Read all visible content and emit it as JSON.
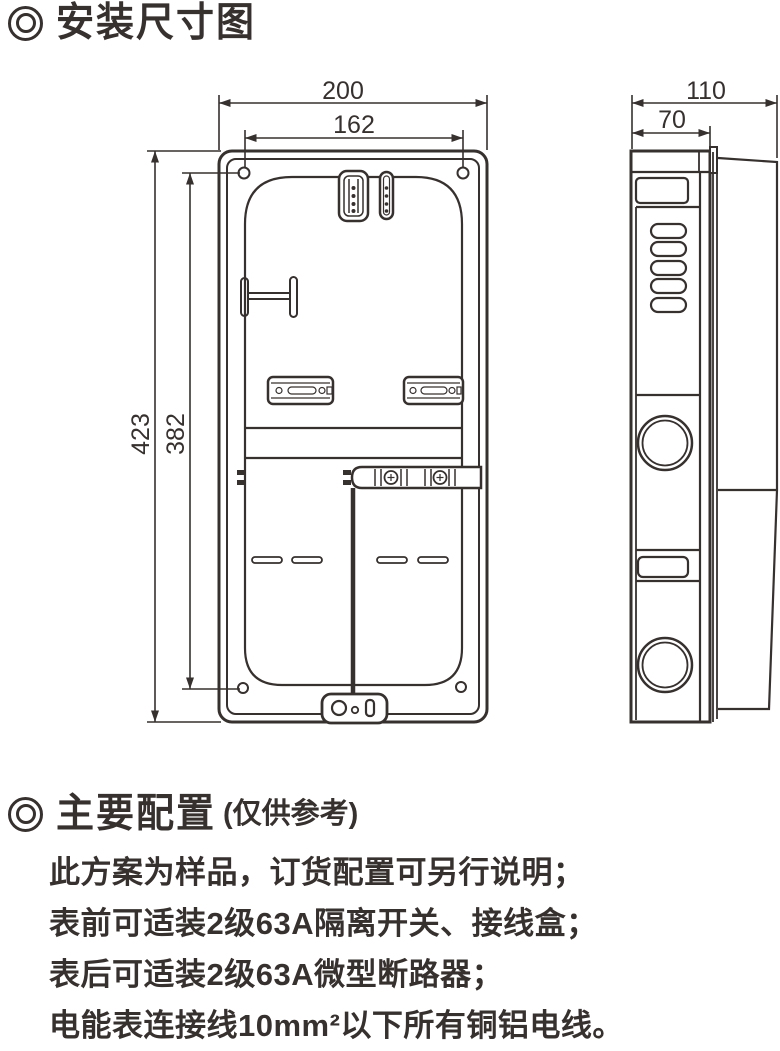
{
  "colors": {
    "ink": "#36302e"
  },
  "section1": {
    "title": "安装尺寸图"
  },
  "dimensions": {
    "front": {
      "width_outer": "200",
      "width_inner": "162",
      "height_outer": "423",
      "height_inner": "382"
    },
    "side": {
      "depth_outer": "110",
      "depth_front": "70"
    }
  },
  "section2": {
    "title": "主要配置",
    "title_note": "(仅供参考)",
    "lines": [
      "此方案为样品，订货配置可另行说明；",
      "表前可适装2级63A隔离开关、接线盒；",
      "表后可适装2级63A微型断路器；",
      "电能表连接线10mm²以下所有铜铝电线。"
    ]
  }
}
